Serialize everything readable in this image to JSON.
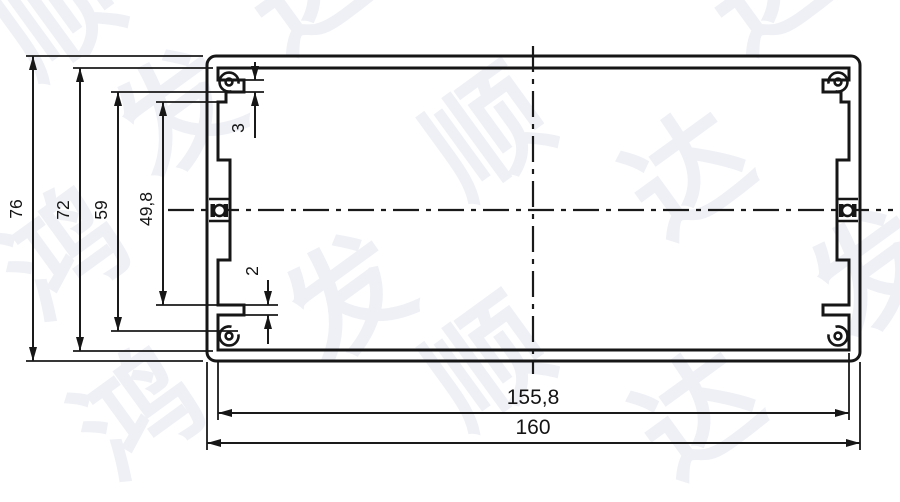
{
  "drawing": {
    "background": "#ffffff",
    "line_color": "#161616",
    "watermark_color": "#eef0f5"
  },
  "dimensions": {
    "overall_height": "76",
    "inner_height": "72",
    "slot_height": "59",
    "opening_height": "49,8",
    "top_ledge_thickness": "3",
    "bottom_ledge_thickness": "2",
    "inner_width": "155,8",
    "overall_width": "160"
  },
  "watermark": {
    "text": "鸿发顺达",
    "chars": [
      "顺",
      "达",
      "发",
      "顺",
      "达",
      "达",
      "鸿",
      "发",
      "顺",
      "达",
      "鸿",
      "发"
    ]
  }
}
